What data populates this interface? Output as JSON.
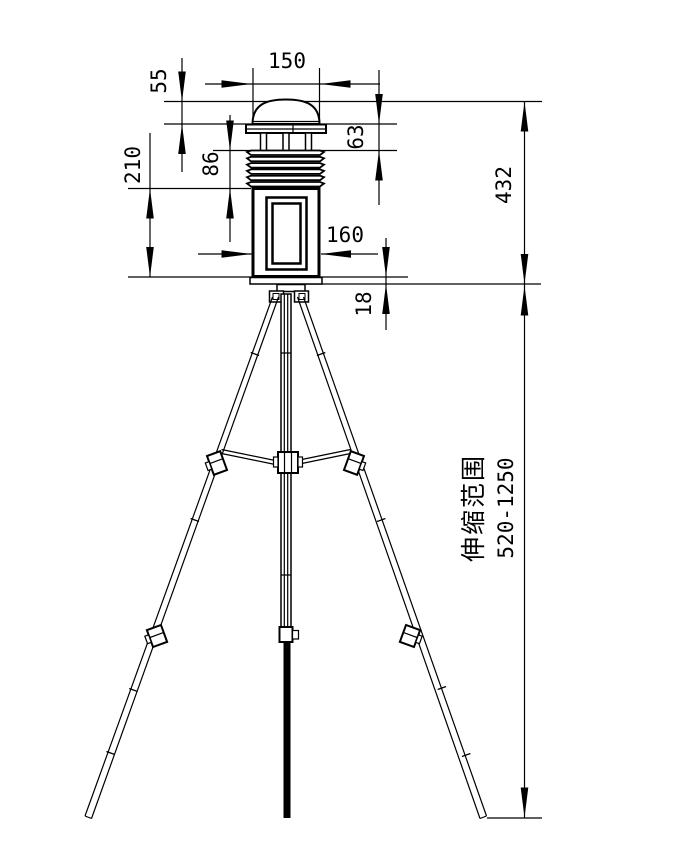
{
  "drawing": {
    "background": "#ffffff",
    "line_color": "#000000",
    "dims": {
      "top_width": "150",
      "dome_height": "55",
      "head_height": "63",
      "shield_height": "86",
      "body_height": "210",
      "body_width": "160",
      "mount_gap": "18",
      "unit_height": "432",
      "telescopic_label": "伸缩范围",
      "telescopic_range": "520-1250"
    }
  }
}
